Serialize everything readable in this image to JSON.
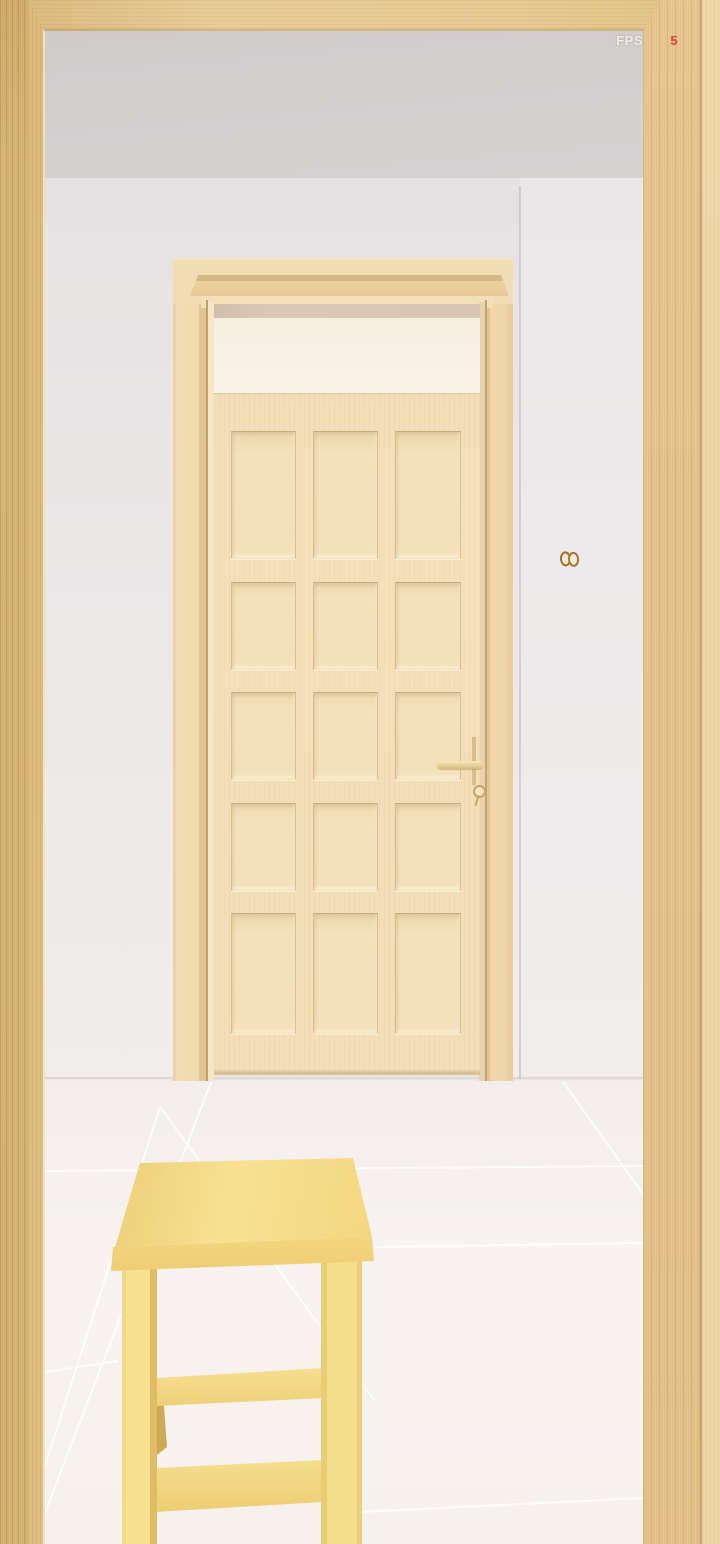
{
  "hud": {
    "fps_label": "FPS",
    "fps_value": "5"
  },
  "scene": {
    "view": "first-person 3d room",
    "door": {
      "type": "wooden panel door",
      "panel_rows": 5,
      "panel_columns": 3,
      "panel_count": 15,
      "has_transom_window": true,
      "handle": "lever handle with keyhole escutcheon",
      "state": "closed"
    },
    "stool": {
      "type": "wooden stool",
      "position": "foreground bottom-left",
      "stretchers": 2
    },
    "wall_fixture": {
      "type": "small socket with two round holes",
      "wall": "right side wall"
    },
    "doorway": {
      "type": "wooden pillars and beam framing the view"
    },
    "floor": {
      "type": "large light tiles with grout lines"
    }
  },
  "colors": {
    "pillar_wood": "#d2b070",
    "beam_wood": "#e8cb93",
    "ceiling": "#d3d0d0",
    "wall": "#eae7e7",
    "wall_right": "#eeecec",
    "floor_tile": "#f6f1ee",
    "door_slab": "#f3dfb9",
    "door_casing": "#f0d9ac",
    "transom_glass": "#f8f2e6",
    "transom_reveal": "#d6c6b2",
    "stool_wood": "#f6dd8b",
    "socket_ring": "#a26e2c",
    "fps_label": "#efedeb",
    "fps_value": "#e04a40"
  }
}
